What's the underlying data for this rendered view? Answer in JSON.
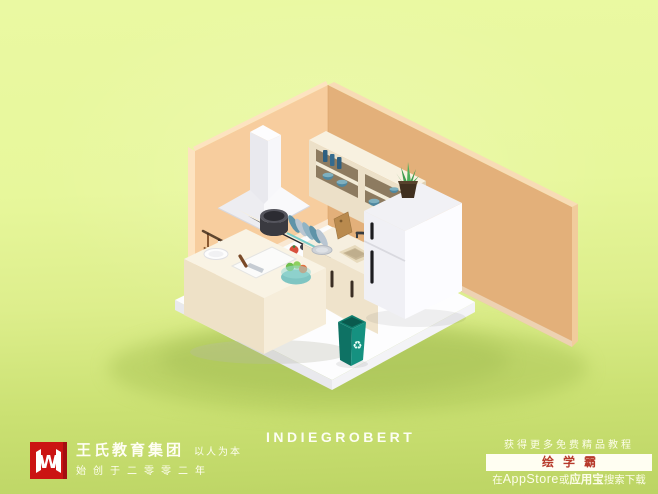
{
  "branding": {
    "logo_monogram": "W",
    "company_name": "王氏教育集团",
    "slogan": "以人为本",
    "founded_line": "始创于二零零二年"
  },
  "watermark": {
    "artist_name": "INDIEGROBERT"
  },
  "promo": {
    "headline": "获得更多免费精品教程",
    "badge_label": "绘学霸",
    "download_prefix": "在",
    "store_name": "AppStore",
    "download_or": "或",
    "store_name_alt": "应用宝",
    "download_suffix": "搜索下载"
  },
  "scene": {
    "description": "Low-poly isometric 3D kitchen room render",
    "recycle_symbol": "♻",
    "objects": [
      "range-hood",
      "wall-cabinet",
      "bottles",
      "blue-bowls",
      "cooktop",
      "pot",
      "stove-counter",
      "sink-counter",
      "sink",
      "faucet",
      "dish-rack",
      "leaning-cutting-board",
      "hanging-utensils",
      "kitchen-island",
      "plate",
      "cutting-board",
      "knife",
      "fruit-bowl",
      "refrigerator",
      "aloe-plant",
      "recycle-bin"
    ]
  },
  "colors": {
    "background_top": "#e9f89e",
    "background_bottom": "#bcd464",
    "wall_left": "#f7cd9e",
    "wall_right": "#e3b07a",
    "floor": "#fdfdfe",
    "cabinet_cream": "#ece0c8",
    "bin_teal": "#12917f",
    "bowl_blue": "#4e87a0",
    "logo_red": "#cb1413",
    "badge_red": "#b73a2b",
    "badge_bg": "#fffef2",
    "text_light": "#fdfdea"
  }
}
